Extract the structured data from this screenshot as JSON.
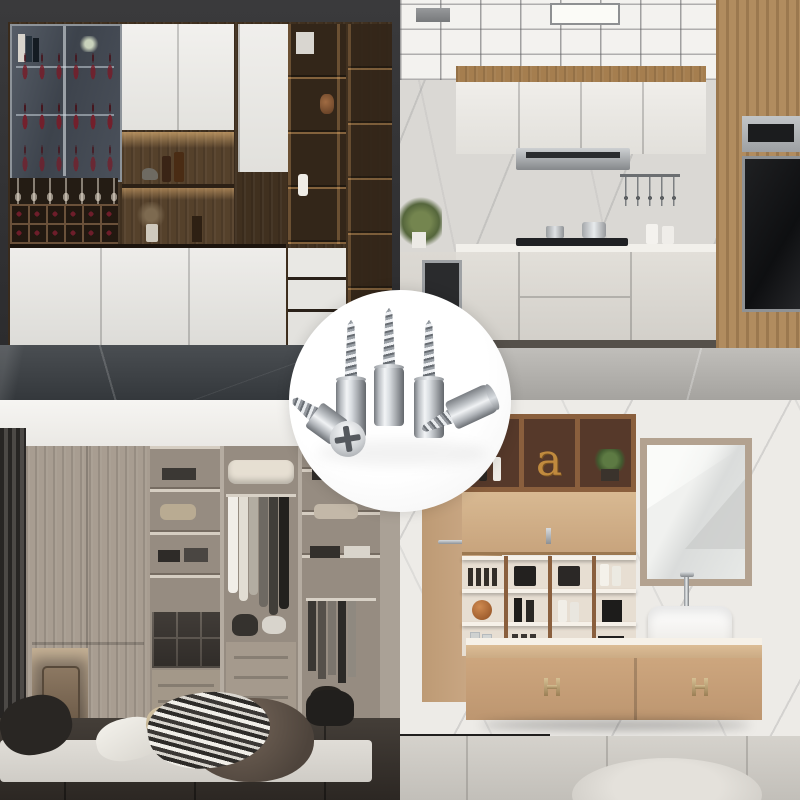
{
  "page": {
    "type": "product-photo-collage",
    "description": "Four furniture interior photos with a circular product inset of metal shelf-support screw pins"
  },
  "badge": {
    "product": "self-tapping shelf support pins",
    "pin_count": 5,
    "pins": [
      "upright-pin-left",
      "upright-pin-center",
      "upright-pin-right",
      "lying-pin-phillips-head",
      "lying-pin-side"
    ]
  },
  "quadrants": [
    {
      "id": "bar-cabinet",
      "scene": "wine bar display cabinet with glass doors and lit shelves"
    },
    {
      "id": "kitchen",
      "scene": "white modern kitchen with grid ceiling and wood appliance column"
    },
    {
      "id": "closet",
      "scene": "walk-in wardrobe with hanging clothes, drawers and pouf"
    },
    {
      "id": "bathroom",
      "scene": "tan floating bathroom vanity with mirror and vessel sink",
      "decor_letter": "a"
    }
  ],
  "palette": {
    "wallDark": "#343436",
    "cabWhite": "#e9e8e5",
    "woodDark": "#40301f",
    "woodMid": "#6b5138",
    "glow": "#e0a96b",
    "glassBlue": "#4d545e",
    "floorDark": "#3f4347",
    "kWood": "#b18c5f",
    "kMarble": "#dad8d4",
    "kBase": "#dcd9d3",
    "black": "#161718",
    "steel": "#b5b8bb",
    "cWood": "#a89d91",
    "cBack": "#968c81",
    "curtain": "#413e3b",
    "rug": "#d6d3cd",
    "tan": "#c79f79",
    "tanLight": "#d2b28c",
    "bWood": "#8a5f3d",
    "frame": "#b3a290",
    "brass": "#b9a27a"
  }
}
